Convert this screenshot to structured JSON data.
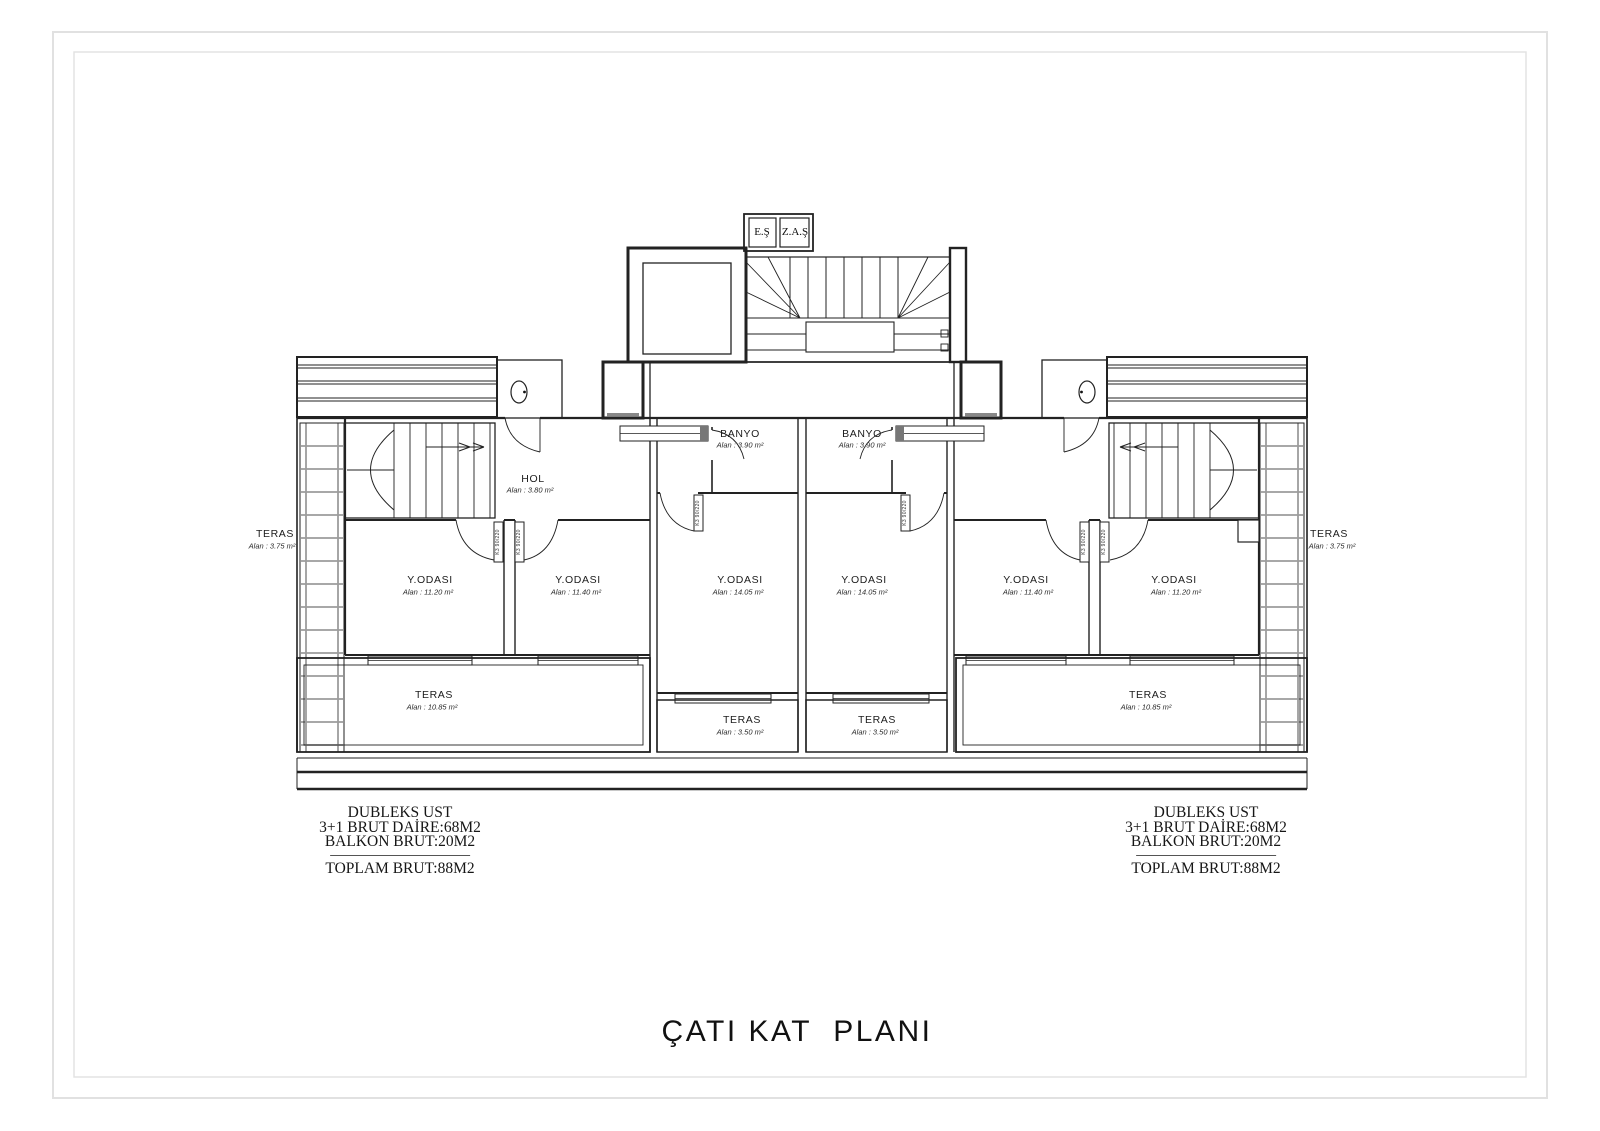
{
  "title": "ÇATI KAT  PLANI",
  "core": {
    "left_shaft_label": "E.Ş",
    "right_shaft_label": "Z.A.Ş"
  },
  "door_label": "K3 90/220",
  "rooms": {
    "hol": {
      "name": "HOL",
      "area": "Alan : 3.80 m²"
    },
    "banyo_left": {
      "name": "BANYO",
      "area": "Alan : 3.90 m²"
    },
    "banyo_right": {
      "name": "BANYO",
      "area": "Alan : 3.90 m²"
    },
    "bedroom_1": {
      "name": "Y.ODASI",
      "area": "Alan : 11.20 m²"
    },
    "bedroom_2": {
      "name": "Y.ODASI",
      "area": "Alan : 11.40 m²"
    },
    "bedroom_3": {
      "name": "Y.ODASI",
      "area": "Alan : 14.05 m²"
    },
    "bedroom_4": {
      "name": "Y.ODASI",
      "area": "Alan : 14.05 m²"
    },
    "bedroom_5": {
      "name": "Y.ODASI",
      "area": "Alan : 11.40 m²"
    },
    "bedroom_6": {
      "name": "Y.ODASI",
      "area": "Alan : 11.20 m²"
    },
    "teras_side_left": {
      "name": "TERAS",
      "area": "Alan : 3.75 m²"
    },
    "teras_side_right": {
      "name": "TERAS",
      "area": "Alan : 3.75 m²"
    },
    "teras_bottom_left": {
      "name": "TERAS",
      "area": "Alan : 10.85 m²"
    },
    "teras_center_left": {
      "name": "TERAS",
      "area": "Alan : 3.50 m²"
    },
    "teras_center_right": {
      "name": "TERAS",
      "area": "Alan : 3.50 m²"
    },
    "teras_bottom_right": {
      "name": "TERAS",
      "area": "Alan : 10.85 m²"
    }
  },
  "summary_left": {
    "line1": "DUBLEKS UST",
    "line2": "3+1 BRUT DAİRE:68M2",
    "line3": "BALKON BRUT:20M2",
    "total": "TOPLAM BRUT:88M2"
  },
  "summary_right": {
    "line1": "DUBLEKS UST",
    "line2": "3+1 BRUT DAİRE:68M2",
    "line3": "BALKON BRUT:20M2",
    "total": "TOPLAM BRUT:88M2"
  }
}
